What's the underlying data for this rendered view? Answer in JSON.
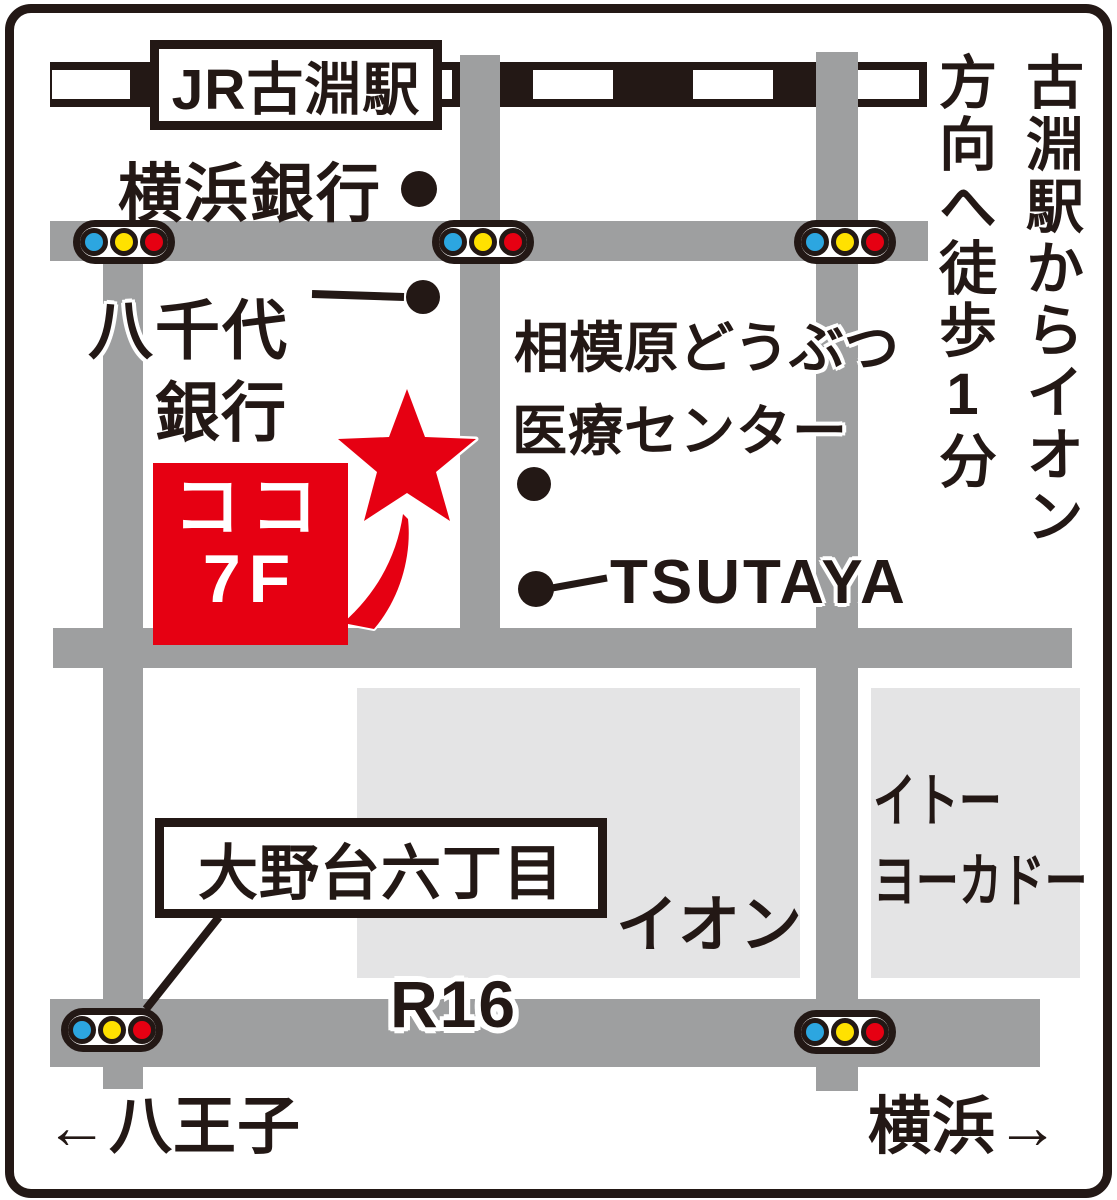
{
  "colors": {
    "ink": "#231815",
    "road_gray": "#9e9fa0",
    "building_gray": "#e4e4e5",
    "accent_red": "#e60012",
    "signal_blue": "#2ca6e0",
    "signal_yellow": "#ffe100",
    "signal_red": "#e60012"
  },
  "railway": {
    "station_label": "JR古淵駅"
  },
  "labels": {
    "yokohama_bank": "横浜銀行",
    "yachiyo_bank": {
      "line1": "八千代",
      "line2": "銀行"
    },
    "animal_center": {
      "line1": "相模原どうぶつ",
      "line2": "医療センター"
    },
    "tsutaya": "TSUTAYA",
    "aeon": "イオン",
    "ito_yokado": {
      "line1": "イトー",
      "line2": "ヨーカドー"
    },
    "intersection": "大野台六丁目",
    "route": "R16",
    "direction_west": "←八王子",
    "direction_east": "横浜→",
    "walk_note": "古淵駅からイオン方向へ徒歩1分"
  },
  "here_marker": {
    "line1": "ココ",
    "line2": "7F"
  },
  "icons": {
    "star": "location-star-icon",
    "dot": "poi-dot-icon",
    "traffic_light": "traffic-light-icon"
  }
}
